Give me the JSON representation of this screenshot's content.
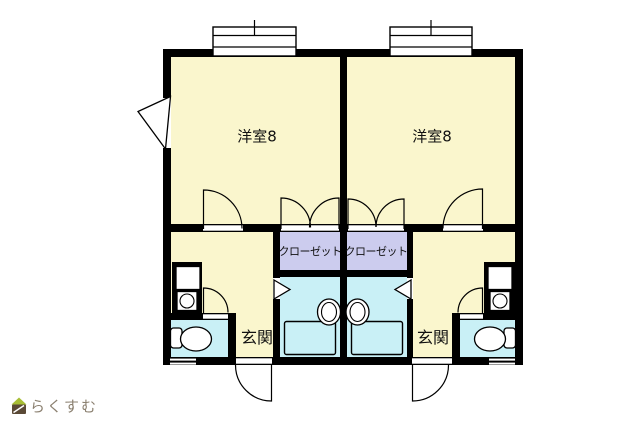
{
  "floorplan": {
    "units": [
      {
        "name": "left-unit",
        "rooms": {
          "main": "洋室8",
          "closet": "クローゼット",
          "entrance": "玄関"
        }
      },
      {
        "name": "right-unit",
        "rooms": {
          "main": "洋室8",
          "closet": "クローゼット",
          "entrance": "玄関"
        }
      }
    ],
    "colors": {
      "wall": "#000000",
      "room_fill": "#FAF6CD",
      "closet_fill": "#CCCCEE",
      "wet_area_fill": "#C9F0F6",
      "background": "#FFFFFF"
    }
  },
  "watermark": {
    "text": "らくすむ",
    "text_color": "#8B8070",
    "logo_roof_color": "#A8BE35",
    "logo_body_color": "#5A4936"
  }
}
